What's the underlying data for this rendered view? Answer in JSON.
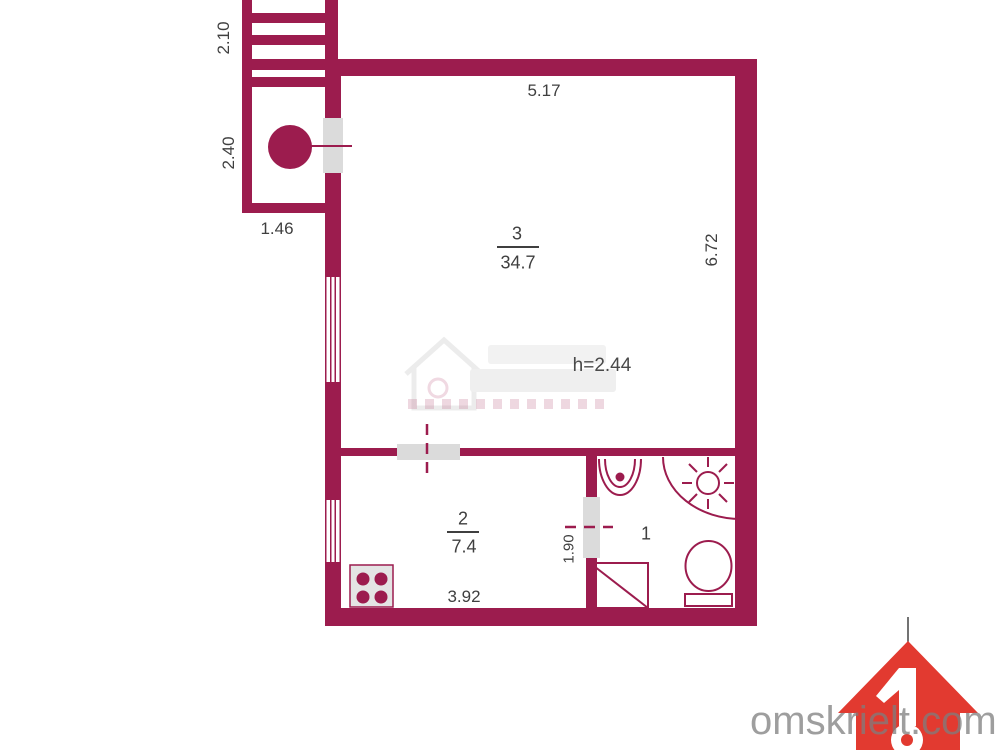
{
  "floorplan": {
    "wall_color": "#9C1C4E",
    "rooms": [
      {
        "number": "3",
        "area": "34.7"
      },
      {
        "number": "2",
        "area": "7.4"
      },
      {
        "number": "1"
      }
    ],
    "ceiling_height": "h=2.44",
    "dims": {
      "stairs_width": "2.10",
      "porch_side": "2.40",
      "porch_bottom": "1.46",
      "main_top": "5.17",
      "main_right": "6.72",
      "room2_bottom": "3.92",
      "bath_door": "1.90"
    }
  },
  "watermark": {
    "site": "omskrielt.com",
    "logo_color": "#E23A30"
  }
}
